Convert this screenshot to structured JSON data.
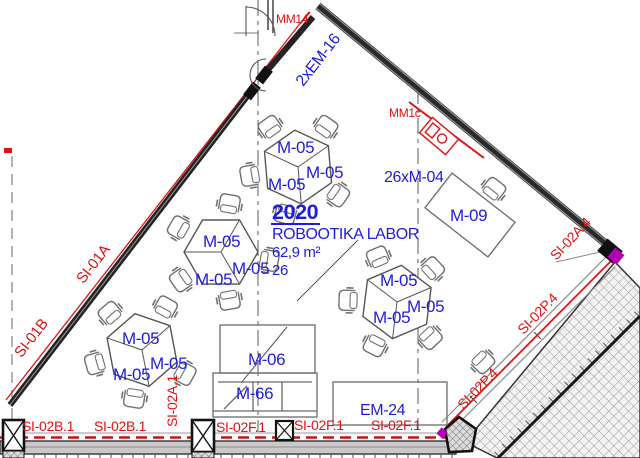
{
  "room": {
    "number": "2020",
    "name": "ROBOOTIKA LABOR",
    "area": "62,9 m²",
    "capacity": "26"
  },
  "furniture": {
    "m05": "M-05",
    "m04_count": "26xM-04",
    "m09": "M-09",
    "m06": "M-06",
    "m66": "M-66",
    "em24": "EM-24",
    "em16": "2xEM-16"
  },
  "tags": {
    "mm14": "MM14",
    "mm1c": "MM1c",
    "si01a": "SI-01A",
    "si01b": "SI-01B",
    "si02b1": "SI-02B.1",
    "si02a1": "SI-02A.1",
    "si02f1": "SI-02F.1",
    "si02p4": "SI-02P.4",
    "si02a4": "SI-02A.4"
  },
  "colors": {
    "label_blue": "#1d1de0",
    "tag_red": "#e31212",
    "wall_dark": "#232323",
    "accent_magenta": "#b400b4"
  }
}
